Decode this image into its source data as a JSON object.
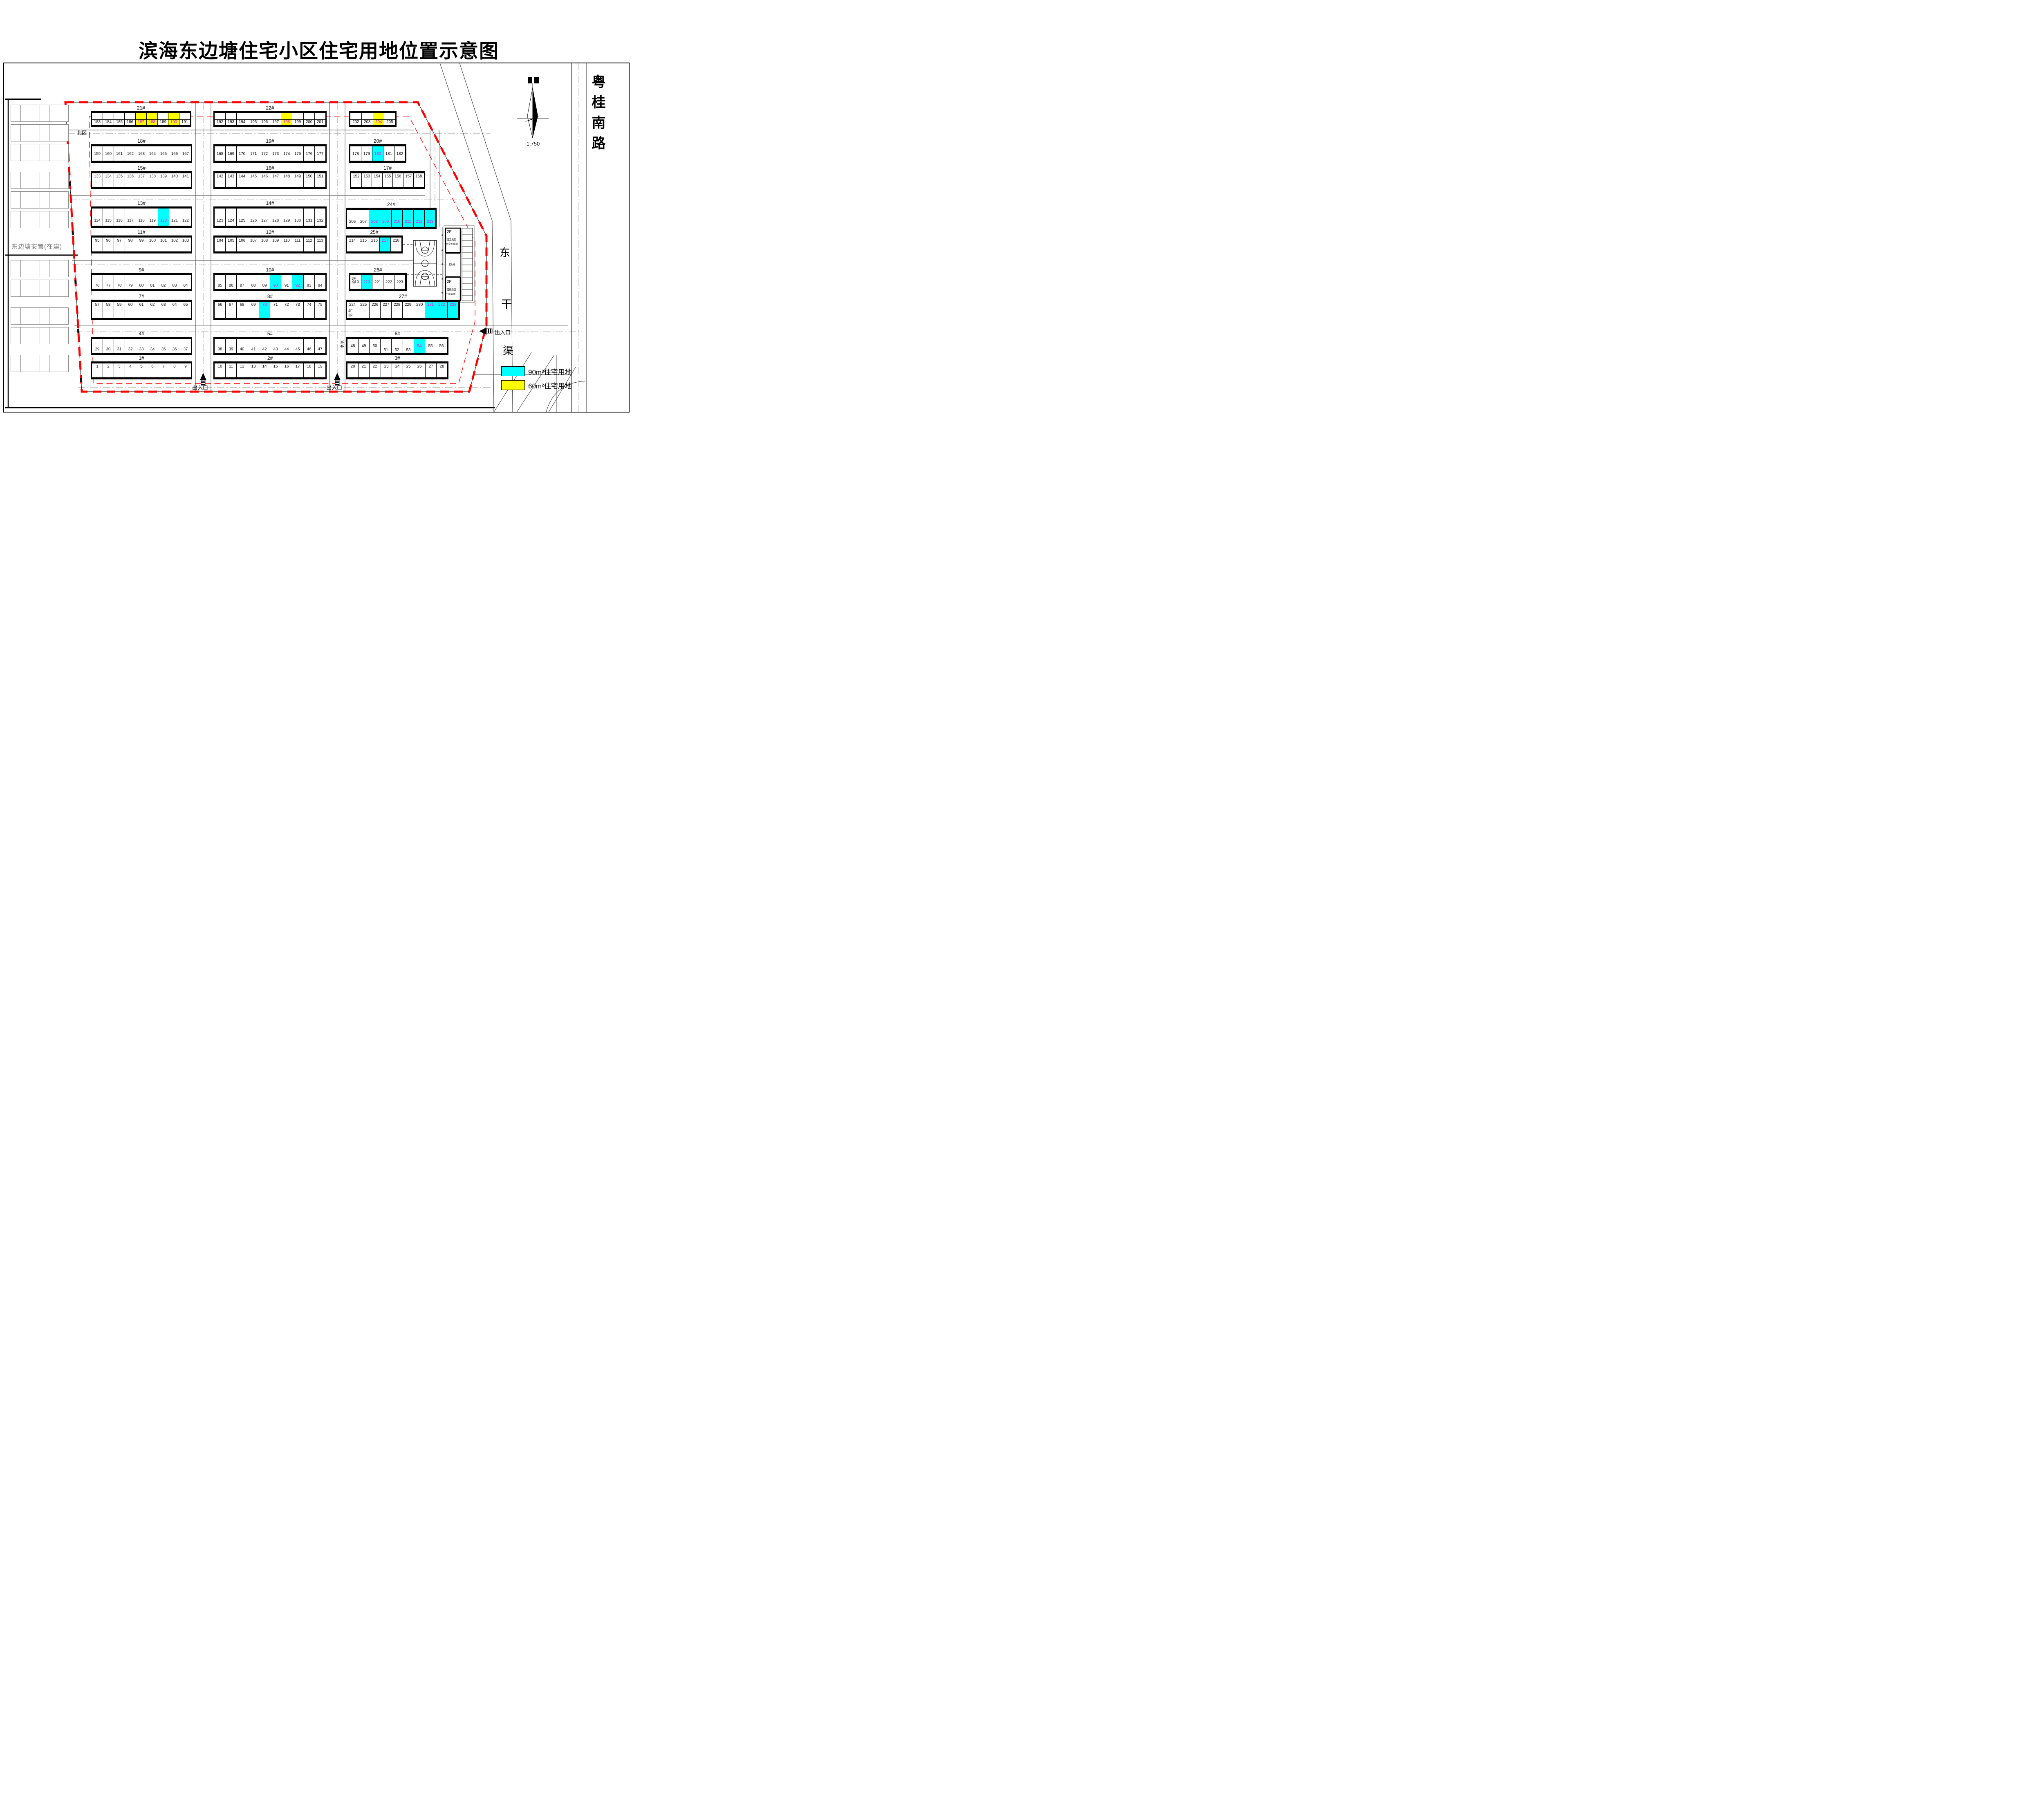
{
  "title": "滨海东边塘住宅小区住宅用地位置示意图",
  "scale_label": "1:750",
  "legend": {
    "items": [
      {
        "color": "#00FFFF",
        "label": "90m²住宅用地"
      },
      {
        "color": "#FFFF00",
        "label": "60m²住宅用地"
      }
    ]
  },
  "labels": {
    "north_zone": "北区",
    "west_area": "东边塘安置(在建)",
    "road_east": "粤桂南路",
    "canal_chars": [
      "东",
      "干",
      "渠"
    ],
    "entrance": "出入口"
  },
  "facility": {
    "building_top": {
      "floor": "2F",
      "line1": "二层工具房",
      "line2": "一层变配电房"
    },
    "stage": "戏台",
    "building_bottom": {
      "floor": "2F",
      "line1": "二层娱乐室",
      "line2": "一层公厕"
    }
  },
  "rows": [
    {
      "id": "21#",
      "start": 183,
      "end": 191,
      "yellow": [
        187,
        188,
        190
      ]
    },
    {
      "id": "22#",
      "start": 192,
      "end": 201,
      "yellow": [
        198
      ]
    },
    {
      "id": "",
      "start": 202,
      "end": 205,
      "yellow": [
        204
      ]
    },
    {
      "id": "18#",
      "start": 159,
      "end": 167
    },
    {
      "id": "19#",
      "start": 168,
      "end": 177
    },
    {
      "id": "20#",
      "start": 178,
      "end": 182,
      "cyan": [
        180
      ]
    },
    {
      "id": "15#",
      "start": 133,
      "end": 141
    },
    {
      "id": "16#",
      "start": 142,
      "end": 151
    },
    {
      "id": "17#",
      "start": 152,
      "end": 158
    },
    {
      "id": "13#",
      "start": 114,
      "end": 122,
      "cyan": [
        120
      ]
    },
    {
      "id": "14#",
      "start": 123,
      "end": 132
    },
    {
      "id": "24#",
      "start": 206,
      "end": 213,
      "cyan": [
        208,
        209,
        210,
        211,
        212,
        213
      ]
    },
    {
      "id": "11#",
      "start": 95,
      "end": 103
    },
    {
      "id": "12#",
      "start": 104,
      "end": 113
    },
    {
      "id": "25#",
      "start": 214,
      "end": 218,
      "cyan": [
        217
      ]
    },
    {
      "id": "9#",
      "start": 76,
      "end": 84
    },
    {
      "id": "10#",
      "start": 85,
      "end": 94,
      "cyan": [
        90,
        92
      ]
    },
    {
      "id": "26#",
      "start": 219,
      "end": 223,
      "cyan": [
        220
      ],
      "floors": [
        "3F",
        "4F"
      ],
      "floors_pos": "inside-left"
    },
    {
      "id": "7#",
      "start": 57,
      "end": 65
    },
    {
      "id": "8#",
      "start": 66,
      "end": 75,
      "cyan": [
        70
      ]
    },
    {
      "id": "27#",
      "start": 224,
      "end": 233,
      "cyan": [
        231,
        232,
        233
      ],
      "floors": [
        "4F",
        "3F"
      ],
      "floors_pos": "inside-left-bottom"
    },
    {
      "id": "4#",
      "start": 29,
      "end": 37
    },
    {
      "id": "5#",
      "start": 38,
      "end": 47
    },
    {
      "id": "6#",
      "start": 48,
      "end": 56,
      "cyan": [
        54
      ],
      "floors": [
        "3F",
        "4F"
      ],
      "floors_pos": "outside-left",
      "low_nums": [
        51,
        52,
        53
      ]
    },
    {
      "id": "1#",
      "start": 1,
      "end": 9
    },
    {
      "id": "2#",
      "start": 10,
      "end": 19
    },
    {
      "id": "3#",
      "start": 20,
      "end": 28
    }
  ]
}
